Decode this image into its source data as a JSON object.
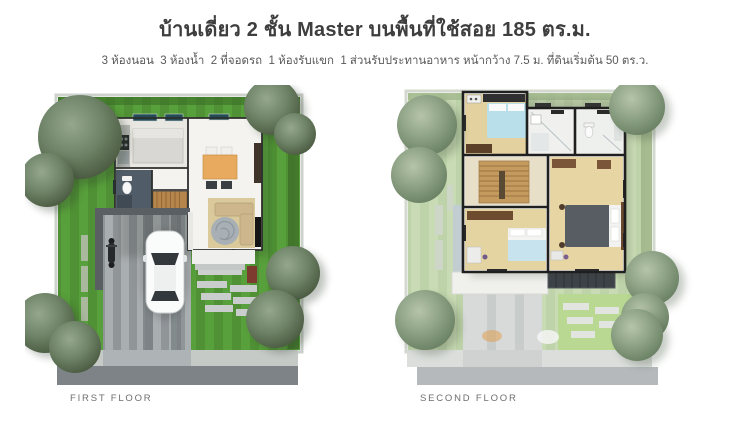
{
  "header": {
    "title": "บ้านเดี่ยว 2 ชั้น Master บนพื้นที่ใช้สอย 185 ตร.ม.",
    "subtitle": "3 ห้องนอน  3 ห้องน้ำ  2 ที่จอดรถ  1 ห้องรับแขก  1 ส่วนรับประทานอาหาร หน้ากว้าง 7.5 ม. ที่ดินเริ่มต้น 50 ตร.ว."
  },
  "plans": {
    "first": {
      "label": "FIRST FLOOR"
    },
    "second": {
      "label": "SECOND FLOOR"
    }
  },
  "colors": {
    "background": "#ffffff",
    "title_text": "#3e3e3e",
    "subtitle_text": "#595959",
    "caption_text": "#6e6e6e",
    "lawn_first_floor": "#4f9134",
    "lawn_stripe_first_floor": "#58a03b",
    "lawn_second_floor": "#bfd3aa",
    "lawn_stripe_second_floor": "#c9dbb4",
    "road_first_floor": "#7d8386",
    "road_second_floor": "#b5b9bc"
  }
}
